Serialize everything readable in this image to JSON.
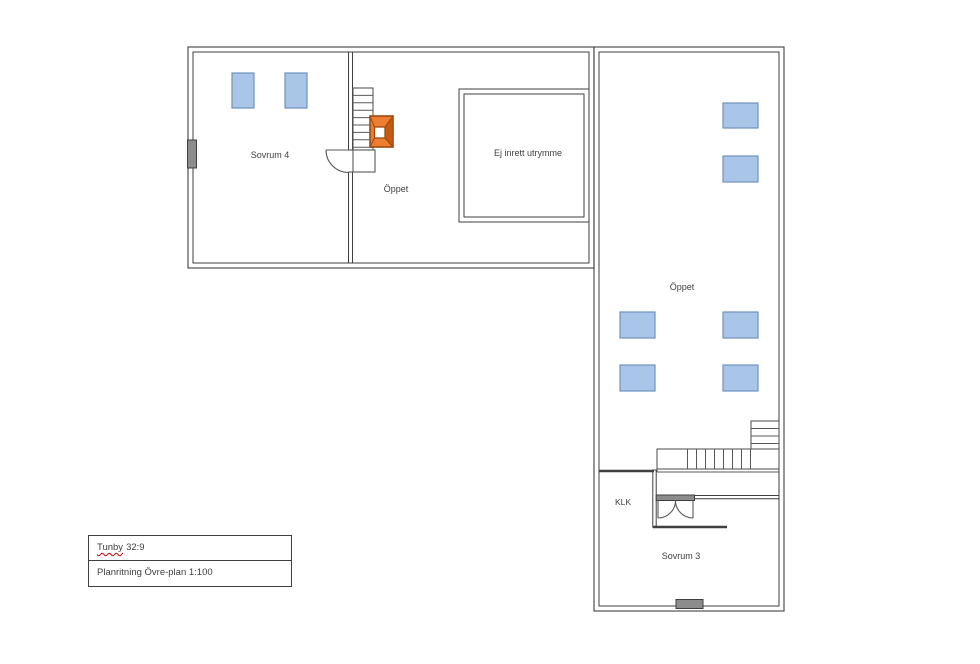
{
  "plan": {
    "rooms": {
      "sovrum4": "Sovrum 4",
      "oppet_mid": "Öppet",
      "ej_inrett": "Ej inrett utrymme",
      "oppet_wing": "Öppet",
      "klk": "KLK",
      "sovrum3": "Sovrum 3"
    },
    "colors": {
      "wall": "#3f3f3f",
      "stair": "#595959",
      "text": "#404040",
      "skylight_fill": "#a9c5e8",
      "skylight_border": "#6e93bd",
      "window_fill": "#8c8c8c",
      "chimney_fill": "#ed7d31",
      "chimney_dark": "#c55a11",
      "chimney_border": "#9c4a12",
      "underline": "#c00000"
    }
  },
  "title_block": {
    "property": "Tunby",
    "property_number": "32:9",
    "drawing_title": "Planritning Övre-plan 1:100"
  }
}
